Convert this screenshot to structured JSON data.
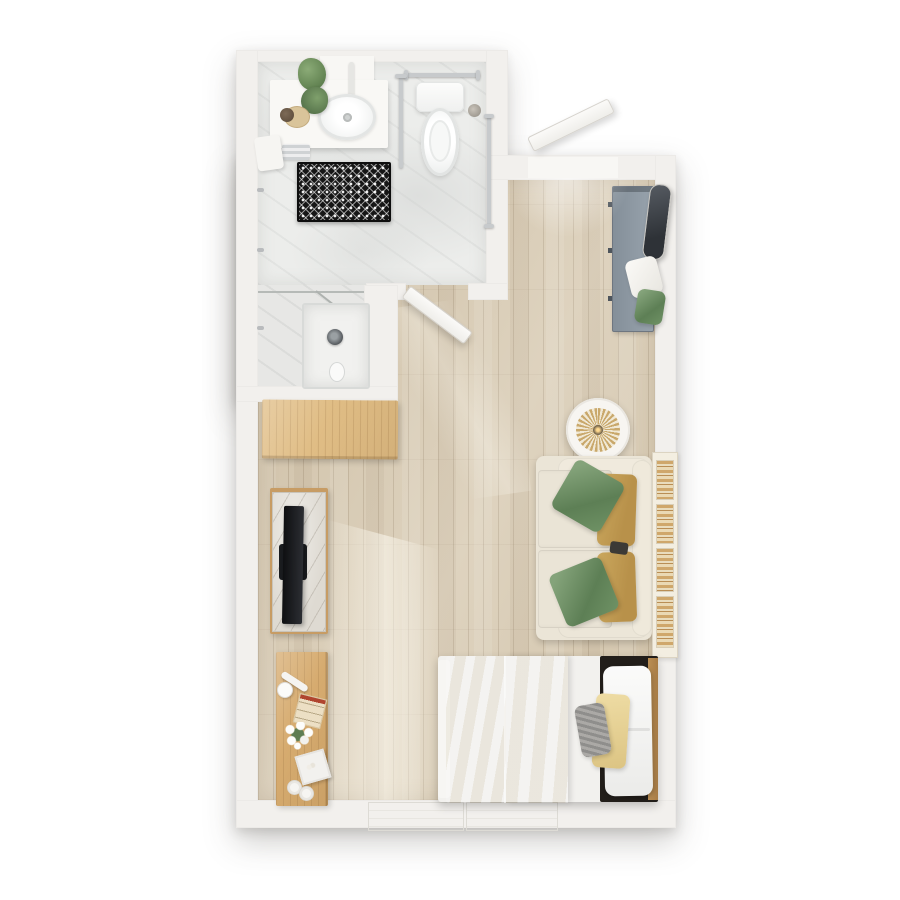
{
  "scene": {
    "title": "Studio apartment 3D floor plan",
    "view": "top-down 3D rendering",
    "background": "#ffffff"
  },
  "palette": {
    "wall": "#f2f0ed",
    "wood_floor": "#d6c8af",
    "bath_marble": "#ecedeb",
    "sofa_cream": "#ebe5d7",
    "pillow_green": "#6d8f66",
    "pillow_gold": "#c3a35c",
    "duvet_gold": "#e9d7a2",
    "bench_gray": "#8e99a2",
    "desk_wood": "#d6ab6f",
    "cabinet_wood": "#e0bd85",
    "bath_mat": "#161616",
    "tv_black": "#141518"
  },
  "rooms": [
    {
      "id": "bathroom",
      "label": "Bathroom",
      "fixtures": [
        "vanity with sink",
        "toilet",
        "walk-in shower",
        "grab bars",
        "towel bar",
        "patterned bath mat",
        "potted plants"
      ]
    },
    {
      "id": "living",
      "label": "Living / sleeping area",
      "furniture": [
        "entry bench",
        "leaning mirror",
        "loveseat sofa",
        "wall bookshelf",
        "round light fixture",
        "TV console",
        "television",
        "wood cabinet",
        "writing desk",
        "bed",
        "double window"
      ]
    }
  ],
  "labels": {
    "unit": "Studio floor plan",
    "bathroom_floor": "Bathroom marble floor",
    "shower": "Walk-in shower",
    "shower_pan": "Shower pan",
    "vanity": "Vanity counter",
    "sink": "Sink",
    "faucet": "Faucet",
    "toilet": "Toilet",
    "towel_bar": "Towel bar",
    "grab_bar": "Grab bar",
    "bath_mat": "Patterned bath mat",
    "towel": "Hanging towel",
    "plant": "Potted plant",
    "soap_tray": "Soap tray",
    "entry_door": "Entry door (open)",
    "bath_door": "Bathroom door (open)",
    "bench": "Entry bench",
    "mirror": "Leaning mirror",
    "bench_pillow_white": "White pillow",
    "bench_pillow_green": "Green pillow",
    "pendant": "Round light fixture",
    "sofa": "Loveseat sofa",
    "sofa_seat": "Seat cushion",
    "sofa_pillow_green": "Green accent pillow",
    "sofa_pillow_gold": "Gold lumbar pillow",
    "bookshelf": "Wall bookshelf",
    "cabinet": "Wood cabinet",
    "tv_console": "Marble-top TV console",
    "tv": "Television",
    "desk": "Writing desk",
    "desk_lamp": "Desk lamp",
    "desk_letter": "Notepad",
    "desk_flowers": "Flower vase",
    "desk_frame": "Photo frame",
    "desk_cup": "Cup",
    "bed": "Bed",
    "duvet": "Gold duvet",
    "bed_pillow_white": "White pillow",
    "bed_pillow_gold": "Gold lumbar pillow",
    "bed_pillow_gray": "Gray knit pillow",
    "headboard": "Headboard",
    "window": "Window",
    "floor": "Wood floor"
  }
}
